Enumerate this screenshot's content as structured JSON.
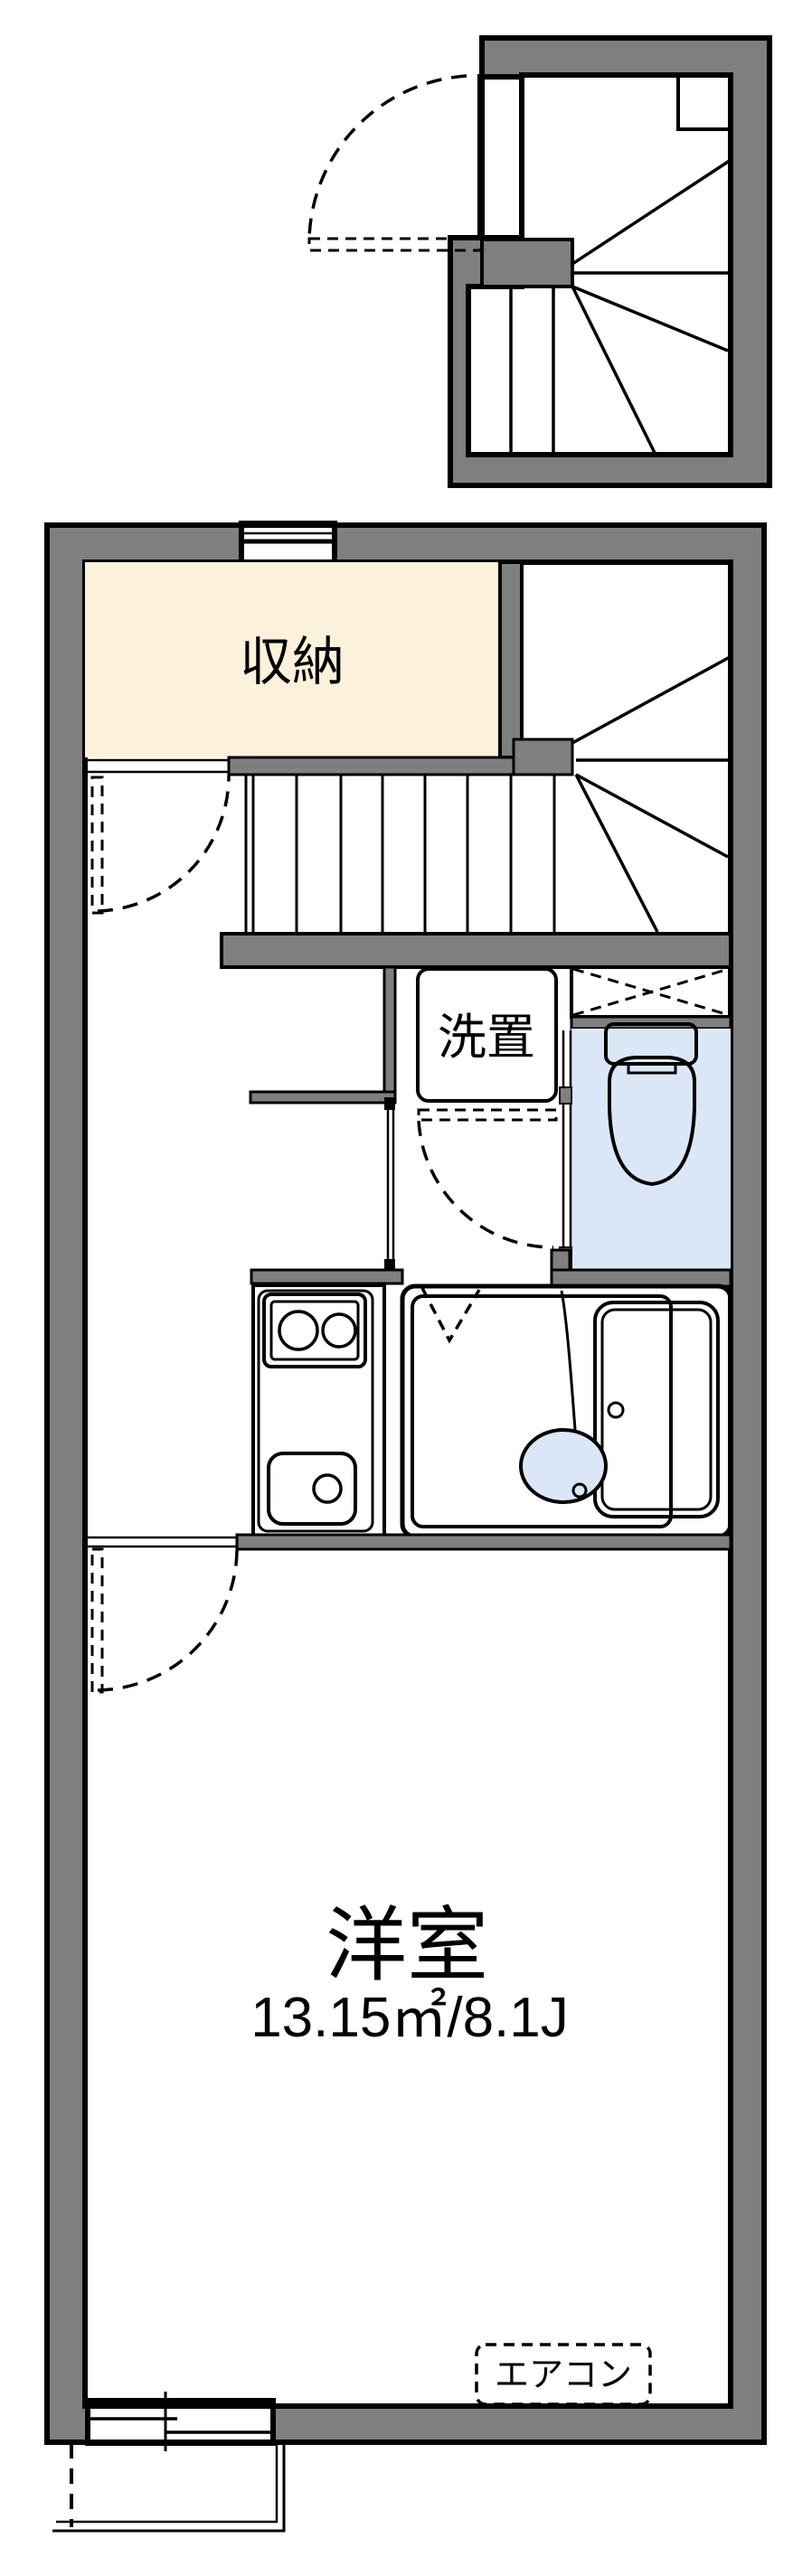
{
  "plan": {
    "type": "floor-plan",
    "rooms": {
      "storage": {
        "label": "収納"
      },
      "laundry": {
        "label": "洗置"
      },
      "bedroom": {
        "label": "洋室",
        "size": "13.15㎡/8.1J"
      },
      "aircon": {
        "label": "エアコン"
      }
    }
  },
  "colors": {
    "wall": "#7f7f7f",
    "line": "#000000",
    "storage_fill": "#fcf2dc",
    "fixture_fill": "#dbe7f7",
    "bg": "#ffffff"
  }
}
